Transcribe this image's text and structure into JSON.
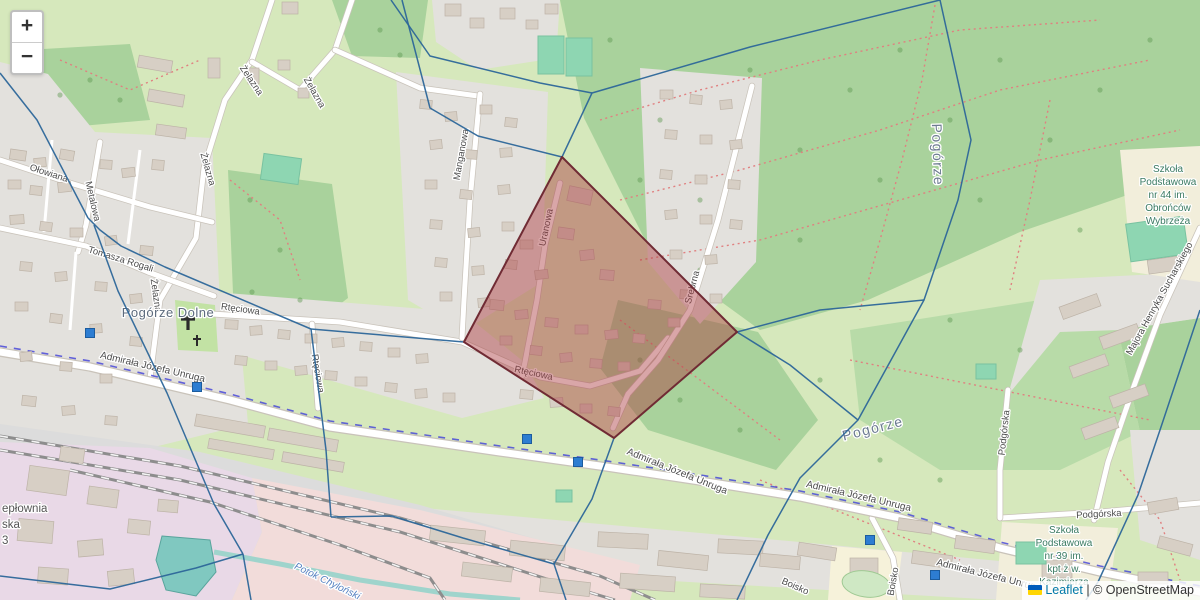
{
  "map_controls": {
    "zoom_in_label": "+",
    "zoom_out_label": "−"
  },
  "attribution": {
    "leaflet_label": "Leaflet",
    "separator": "|",
    "copyright_label": "© OpenStreetMap",
    "flag_top_color": "#005BBB",
    "flag_bottom_color": "#FFD500"
  },
  "overlay": {
    "line_color": "#2c6699",
    "selected_region": {
      "fill": "#ab393d",
      "fill_opacity": 0.45,
      "stroke": "#702b34",
      "points": [
        [
          562,
          157
        ],
        [
          737,
          332
        ],
        [
          614,
          438
        ],
        [
          464,
          342
        ]
      ]
    },
    "network_edges": [
      [
        [
          0,
          73
        ],
        [
          37,
          120
        ],
        [
          88,
          218
        ]
      ],
      [
        [
          88,
          218
        ],
        [
          100,
          230
        ],
        [
          121,
          246
        ],
        [
          165,
          267
        ],
        [
          311,
          329
        ]
      ],
      [
        [
          94,
          225
        ],
        [
          118,
          291
        ],
        [
          167,
          393
        ],
        [
          214,
          504
        ],
        [
          243,
          554
        ]
      ],
      [
        [
          243,
          554
        ],
        [
          251,
          600
        ]
      ],
      [
        [
          0,
          576
        ],
        [
          110,
          589
        ],
        [
          196,
          568
        ],
        [
          243,
          554
        ]
      ],
      [
        [
          311,
          329
        ],
        [
          326,
          450
        ],
        [
          331,
          517
        ]
      ],
      [
        [
          331,
          517
        ],
        [
          392,
          516
        ],
        [
          463,
          538
        ],
        [
          554,
          564
        ]
      ],
      [
        [
          554,
          564
        ],
        [
          566,
          600
        ]
      ],
      [
        [
          554,
          564
        ],
        [
          592,
          499
        ],
        [
          614,
          438
        ]
      ],
      [
        [
          562,
          157
        ],
        [
          592,
          93
        ],
        [
          750,
          47
        ],
        [
          940,
          0
        ]
      ],
      [
        [
          592,
          93
        ],
        [
          540,
          83
        ],
        [
          430,
          56
        ],
        [
          391,
          0
        ]
      ],
      [
        [
          940,
          0
        ],
        [
          971,
          140
        ],
        [
          958,
          200
        ],
        [
          924,
          300
        ],
        [
          858,
          420
        ],
        [
          800,
          478
        ],
        [
          768,
          535
        ],
        [
          737,
          600
        ]
      ],
      [
        [
          737,
          332
        ],
        [
          790,
          365
        ],
        [
          858,
          420
        ]
      ],
      [
        [
          737,
          332
        ],
        [
          820,
          310
        ],
        [
          924,
          300
        ]
      ],
      [
        [
          1200,
          310
        ],
        [
          1160,
          430
        ],
        [
          1138,
          495
        ],
        [
          1098,
          582
        ],
        [
          1086,
          600
        ]
      ],
      [
        [
          311,
          329
        ],
        [
          464,
          342
        ]
      ],
      [
        [
          562,
          157
        ],
        [
          478,
          136
        ],
        [
          430,
          108
        ],
        [
          402,
          0
        ]
      ]
    ],
    "stop_markers": {
      "color": "#2d7dd2",
      "border": "#1c5c9e",
      "points": [
        [
          90,
          333
        ],
        [
          197,
          387
        ],
        [
          527,
          439
        ],
        [
          578,
          462
        ],
        [
          870,
          540
        ],
        [
          935,
          575
        ]
      ]
    }
  },
  "labels": {
    "streets": [
      {
        "text": "Ołowiana",
        "x": 48,
        "y": 176,
        "r": 18
      },
      {
        "text": "Metalowa",
        "x": 90,
        "y": 202,
        "r": 77
      },
      {
        "text": "Tomasza Rogali",
        "x": 120,
        "y": 262,
        "r": 17
      },
      {
        "text": "Żelazna",
        "x": 205,
        "y": 170,
        "r": 74
      },
      {
        "text": "Żelazna",
        "x": 249,
        "y": 82,
        "r": 56
      },
      {
        "text": "Żelazna",
        "x": 312,
        "y": 94,
        "r": 60
      },
      {
        "text": "Żelazna",
        "x": 153,
        "y": 296,
        "r": 82
      },
      {
        "text": "Rtęciowa",
        "x": 240,
        "y": 312,
        "r": 8
      },
      {
        "text": "Rtęciowa",
        "x": 315,
        "y": 374,
        "r": 80
      },
      {
        "text": "Rtęciowa",
        "x": 533,
        "y": 376,
        "r": 12
      },
      {
        "text": "Uranowa",
        "x": 549,
        "y": 228,
        "r": -78
      },
      {
        "text": "Manganowa",
        "x": 464,
        "y": 155,
        "r": -80
      },
      {
        "text": "Srebrna",
        "x": 695,
        "y": 288,
        "r": -75
      },
      {
        "text": "Admirała Józefa Unruga",
        "x": 152,
        "y": 370,
        "r": 13,
        "big": true
      },
      {
        "text": "Admirała Józefa Unruga",
        "x": 676,
        "y": 474,
        "r": 22,
        "big": true
      },
      {
        "text": "Admirała Józefa Unruga",
        "x": 858,
        "y": 499,
        "r": 13,
        "big": true
      },
      {
        "text": "Admirała Józefa Unruga",
        "x": 988,
        "y": 578,
        "r": 14,
        "big": true
      },
      {
        "text": "Podgórska",
        "x": 1099,
        "y": 517,
        "r": -3
      },
      {
        "text": "Podgórska",
        "x": 1007,
        "y": 433,
        "r": -84
      },
      {
        "text": "Majora Henryka Sucharskiego",
        "x": 1162,
        "y": 300,
        "r": -61
      },
      {
        "text": "Boisko",
        "x": 794,
        "y": 589,
        "r": 24
      },
      {
        "text": "Boisko",
        "x": 896,
        "y": 582,
        "r": -80
      }
    ],
    "places": [
      {
        "text": "Pogórze Dolne",
        "x": 168,
        "y": 317,
        "r": 0,
        "big": false
      },
      {
        "text": "Pogórze",
        "x": 933,
        "y": 155,
        "r": 88,
        "big": true
      },
      {
        "text": "Pogórze",
        "x": 874,
        "y": 433,
        "r": -14,
        "big": true
      }
    ],
    "pois": [
      {
        "lines": [
          "Szkoła",
          "Podstawowa",
          "nr 44 im.",
          "Obrońców",
          "Wybrzeża"
        ],
        "x": 1168,
        "y": 172,
        "lh": 13
      },
      {
        "lines": [
          "Szkoła",
          "Podstawowa",
          "nr 39 im.",
          "kpt ż w.",
          "Kazimierza"
        ],
        "x": 1064,
        "y": 533,
        "lh": 13
      }
    ],
    "partial": [
      {
        "lines": [
          "epłownia",
          "ska",
          "3"
        ],
        "x": 2,
        "y": 512,
        "lh": 16
      }
    ],
    "water": [
      {
        "text": "Potok Chyloński",
        "x": 326,
        "y": 584,
        "r": 26
      }
    ]
  }
}
